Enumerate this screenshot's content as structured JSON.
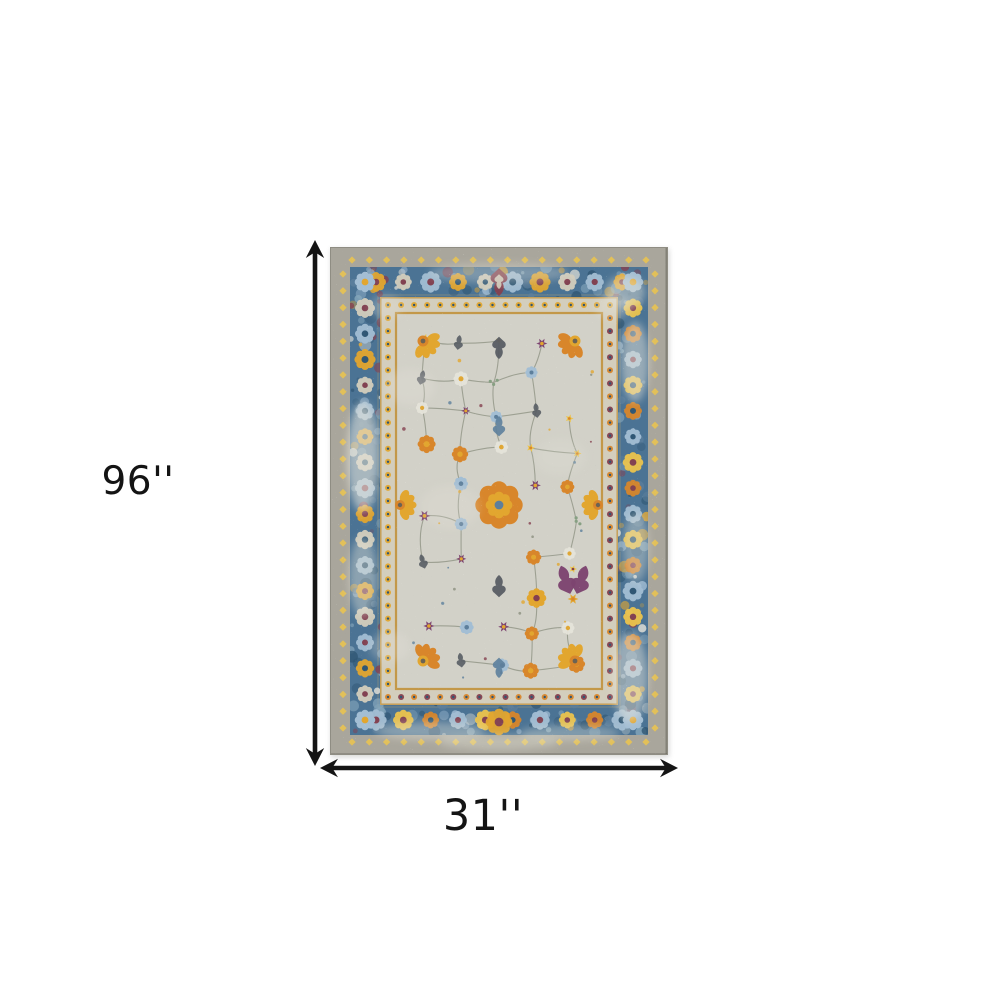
{
  "page": {
    "background_color": "#ffffff"
  },
  "dimension_annotation": {
    "height_label": "96''",
    "width_label": "31''",
    "arrow_color": "#141414"
  },
  "rug": {
    "description": "distressed-vintage-oriental-area-rug",
    "palette": {
      "edge": "#a9a69c",
      "edge_dark": "#8f8d83",
      "border_blue": "#4b7394",
      "border_blue_dark": "#2f5673",
      "border_blue_light": "#86a7bc",
      "guard_cream": "#d3cebd",
      "trim_gold": "#c1923c",
      "field": "#d2d1c8",
      "field_light": "#e6e4da",
      "accent_orange": "#d8862b",
      "accent_gold": "#e2a62f",
      "accent_yellow": "#ecc44d",
      "accent_purple": "#7d4470",
      "accent_maroon": "#85404f",
      "accent_blue": "#a3bed4",
      "accent_steel": "#5d7f9c",
      "accent_gray": "#585d64",
      "accent_green": "#87a083",
      "vine": "#8c9080"
    }
  }
}
